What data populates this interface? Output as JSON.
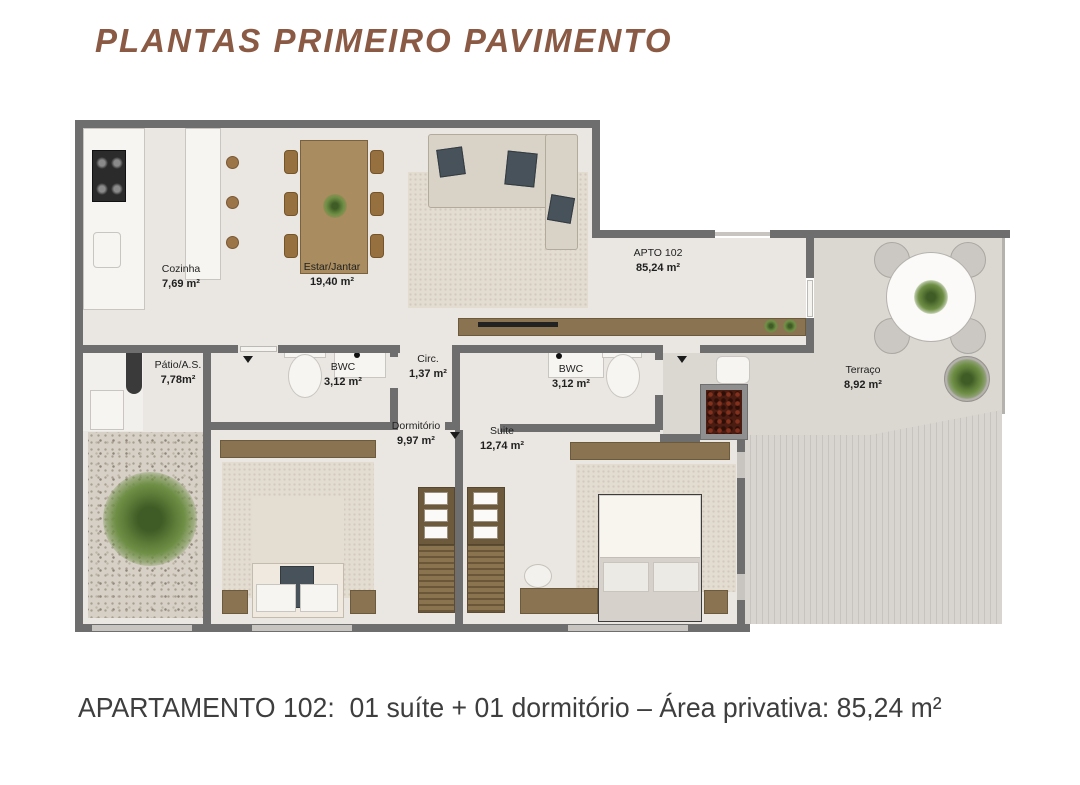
{
  "title": "PLANTAS PRIMEIRO PAVIMENTO",
  "caption": "APARTAMENTO 102:  01 suíte + 01 dormitório – Área privativa: 85,24 m²",
  "apartment": {
    "number": "APTO 102",
    "total_area": "85,24 m²"
  },
  "rooms": [
    {
      "name": "Cozinha",
      "area": "7,69 m²"
    },
    {
      "name": "Estar/Jantar",
      "area": "19,40 m²"
    },
    {
      "name": "APTO 102",
      "area": "85,24 m²"
    },
    {
      "name": "Pátio/A.S.",
      "area": "7,78m²"
    },
    {
      "name": "BWC",
      "area": "3,12 m²"
    },
    {
      "name": "Circ.",
      "area": "1,37 m²"
    },
    {
      "name": "BWC",
      "area": "3,12 m²"
    },
    {
      "name": "Dormitório",
      "area": "9,97 m²"
    },
    {
      "name": "Suite",
      "area": "12,74 m²"
    },
    {
      "name": "Terraço",
      "area": "8,92 m²"
    }
  ],
  "icons": [
    "door-hinge-icon",
    "cooktop-icon",
    "kitchen-sink-icon",
    "laundry-sink-icon",
    "toilet-icon",
    "vanity-sink-icon",
    "bbq-grill-icon",
    "fern-plant-icon",
    "potted-plant-icon",
    "table-plant-icon",
    "sideboard-plant-icon"
  ],
  "colors": {
    "title": "#8a5a44",
    "caption": "#3e3e3e",
    "wall": "#6e6e6e",
    "apartment_floor": "#eae7e2",
    "terrace_floor": "#dbd7d1",
    "wood": "#9b7c55",
    "plant_green": "#5d7c38",
    "bbq_red": "#4a1c12"
  }
}
